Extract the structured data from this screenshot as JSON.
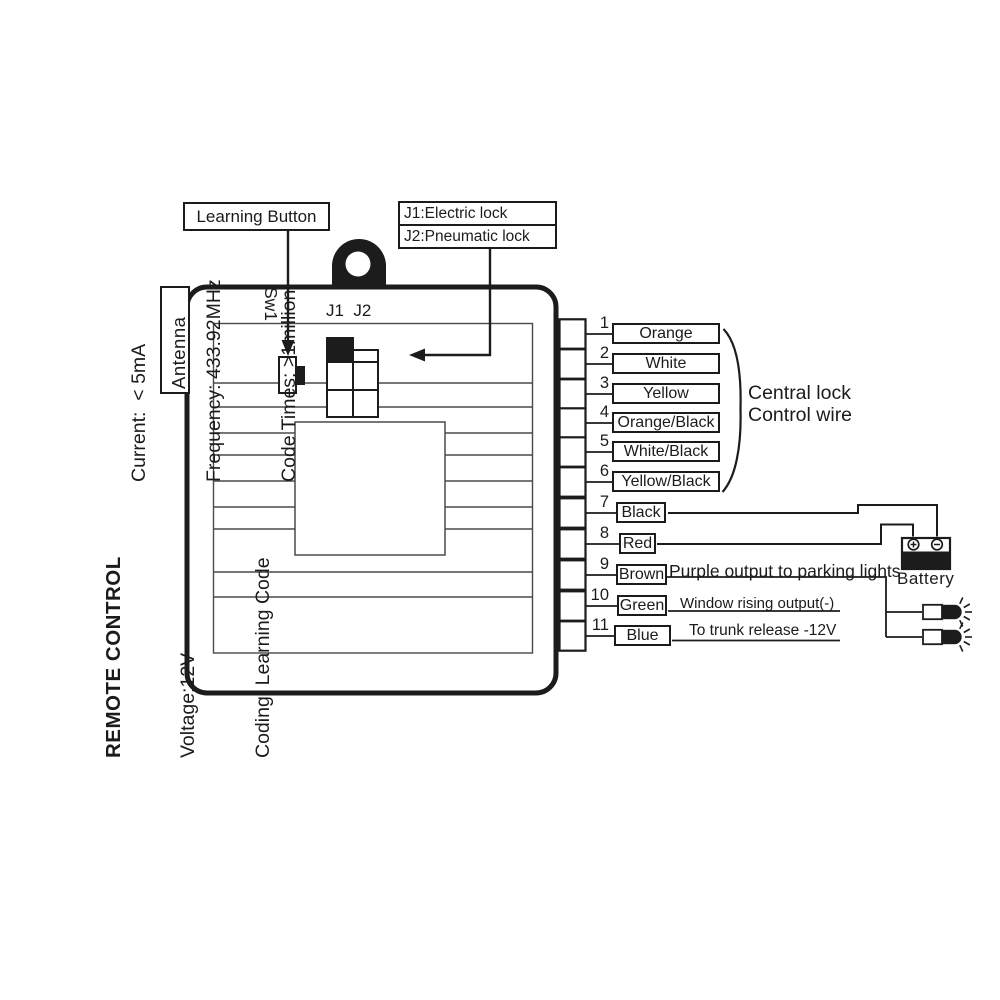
{
  "left_panel": {
    "title_block": {
      "line1": "REMOTE CONTROL",
      "line2": "Voltage:12V",
      "line3": "Coding: Learning Code"
    },
    "specs_block": {
      "line1": "Current:  < 5mA",
      "line2": "Frequency: 433.92MHz",
      "line3": "Code Times: >1million"
    }
  },
  "module": {
    "antenna_label": "Antenna",
    "switch_label": "Sw1",
    "jumper_pins_label": "J1  J2"
  },
  "callouts": {
    "learning_button": "Learning Button",
    "jumper_line1": "J1:Electric lock",
    "jumper_line2": "J2:Pneumatic lock"
  },
  "wires": [
    {
      "num": "1",
      "color": "Orange",
      "note": ""
    },
    {
      "num": "2",
      "color": "White",
      "note": ""
    },
    {
      "num": "3",
      "color": "Yellow",
      "note": ""
    },
    {
      "num": "4",
      "color": "Orange/Black",
      "note": ""
    },
    {
      "num": "5",
      "color": "White/Black",
      "note": ""
    },
    {
      "num": "6",
      "color": "Yellow/Black",
      "note": ""
    },
    {
      "num": "7",
      "color": "Black",
      "note": ""
    },
    {
      "num": "8",
      "color": "Red",
      "note": ""
    },
    {
      "num": "9",
      "color": "Brown",
      "note": "Purple output to parking lights"
    },
    {
      "num": "10",
      "color": "Green",
      "note": "Window rising output(-)"
    },
    {
      "num": "11",
      "color": "Blue",
      "note": "To trunk release -12V"
    }
  ],
  "annotations": {
    "central_lock_line1": "Central lock",
    "central_lock_line2": "Control wire",
    "battery": "Battery"
  },
  "colors": {
    "ink": "#1c1c1c",
    "trace": "#4a4a4a",
    "background": "#ffffff"
  }
}
